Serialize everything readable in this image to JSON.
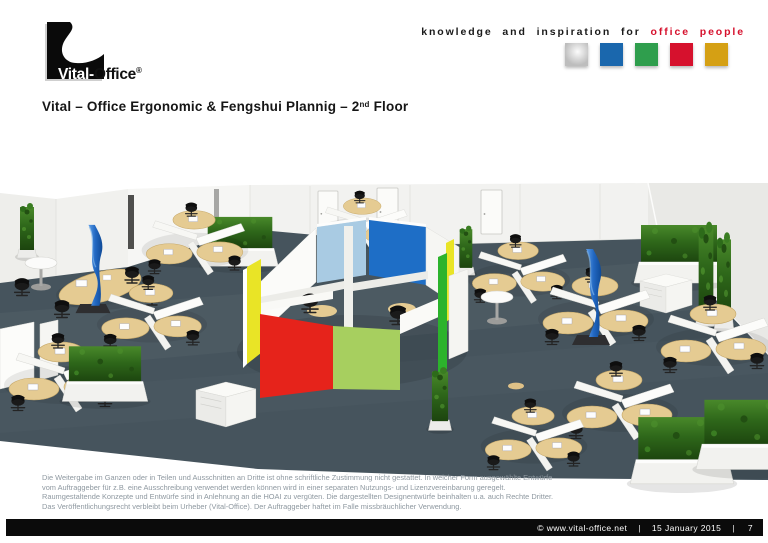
{
  "logo": {
    "brand_white": "Vital-",
    "brand_black": "Office",
    "registered": "®"
  },
  "tagline": {
    "black_part": "knowledge and inspiration for",
    "red_part": "office people",
    "red_color": "#d6112d"
  },
  "brand_squares": [
    {
      "name": "silver",
      "color": "#bdbdbd"
    },
    {
      "name": "blue",
      "color": "#1a67ad"
    },
    {
      "name": "green",
      "color": "#2f9e4d"
    },
    {
      "name": "red",
      "color": "#d6112d"
    },
    {
      "name": "gold",
      "color": "#d5a014"
    }
  ],
  "title": {
    "prefix": "Vital – Office Ergonomic & Fengshui Plannig  – 2",
    "superscript": "nd",
    "suffix": " Floor"
  },
  "scene": {
    "description": "3D rendering of 2nd floor open-plan office: Y-shaped desk clusters with white partitions and curved wooden desktops, central cube meeting room with coloured acoustic panels, plant columns, plant walls, blue pillars and round bistro tables on dark carpet",
    "colors": {
      "carpet": "#46545d",
      "walls": "#f2f2f0",
      "desk_wood": "#e5cb92",
      "partition_white": "#fbfbfa",
      "plant_green": "#2f7a1d",
      "pillar_blue": "#1d66c0",
      "pod_back_left_panel": "#a9cbe3",
      "pod_back_right_panel": "#1e6ec6",
      "pod_front_left_panel": "#e6231b",
      "pod_front_right_panel": "#a7cf5f",
      "pod_side_panel_yellow": "#e9e426",
      "pod_side_panel_green": "#2cb32c"
    }
  },
  "disclaimer": {
    "text": "Die Weitergabe im Ganzen oder in Teilen und Ausschnitten an Dritte ist ohne schriftliche Zustimmung nicht gestattet. In welcher Form ausgewählte Entwürfe vom Auftraggeber für z.B. eine Ausschreibung verwendet werden können wird in einer separaten Nutzungs- und Lizenzvereinbarung geregelt. Raumgestaltende Konzepte und Entwürfe sind in Anlehnung an die HOAI zu vergüten. Die dargestellten Designentwürfe beinhalten u.a. auch Rechte Dritter. Das Veröffentlichungsrecht verbleibt beim Urheber (Vital-Office). Der Auftraggeber haftet im Falle missbräuchlicher Verwendung."
  },
  "footer": {
    "copyright": "©  www.vital-office.net",
    "separator1": "|",
    "date": "15 January 2015",
    "separator2": "|",
    "page_number": "7"
  }
}
